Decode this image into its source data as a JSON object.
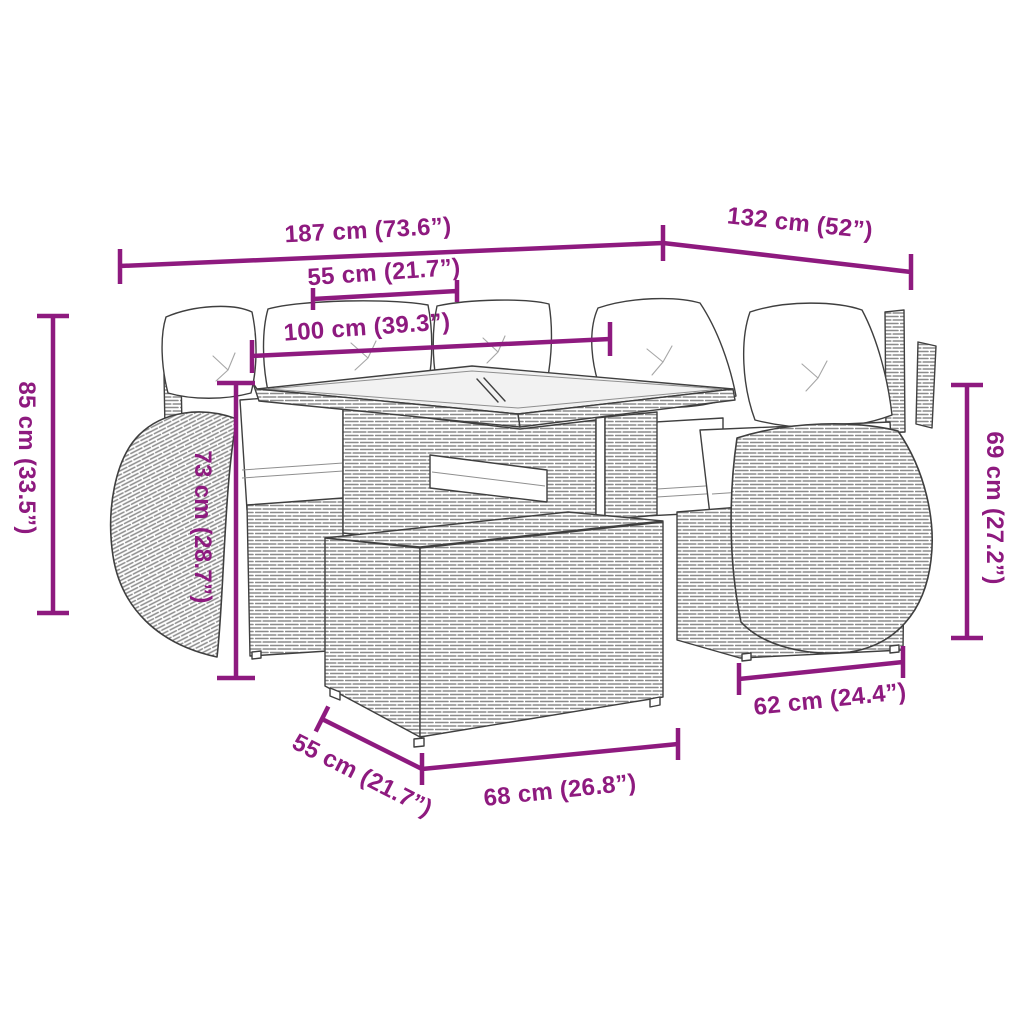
{
  "colors": {
    "accent": "#8E1A7F",
    "sketch": "#3f3f3f",
    "weave": "#8b8b8b",
    "glass": "#f2f2f2"
  },
  "dimensions": {
    "back_width": "187 cm (73.6”)",
    "side_width": "132 cm (52”)",
    "table_width": "55 cm (21.7”)",
    "table_length": "100 cm (39.3”)",
    "total_height": "85 cm (33.5”)",
    "table_height": "73 cm (28.7”)",
    "arm_height": "69 cm (27.2”)",
    "side_depth": "62 cm (24.4”)",
    "ottoman_depth": "55 cm (21.7”)",
    "ottoman_width": "68 cm (26.8”)"
  }
}
